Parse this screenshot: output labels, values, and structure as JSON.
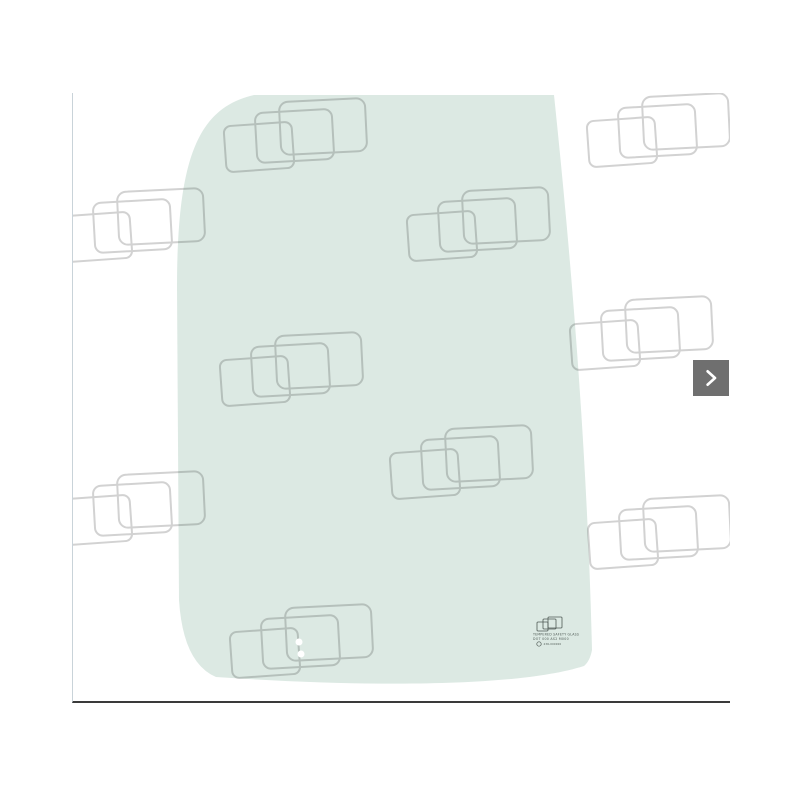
{
  "viewer": {
    "type": "product-image-carousel",
    "background": "#ffffff",
    "border_left_color": "#c9d3d9",
    "border_bottom_color": "#3a3a3a"
  },
  "image": {
    "subject": "curved vehicle door glass panel with watermark pattern",
    "glass_color": "#dce9e3",
    "hole_color": "#ffffff",
    "watermark_color": "#d2d2d2",
    "watermark_tiles": 10,
    "mounting_holes": 2,
    "stamp": {
      "color": "#4f5a55",
      "line1": "TEMPERED SAFETY GLASS",
      "line2": "DOT 000 AS2 M000",
      "line3": "43R-000000"
    }
  },
  "carousel": {
    "next_button": {
      "background": "#6f6f6f",
      "icon": "chevron-right",
      "icon_color": "#ffffff"
    }
  }
}
